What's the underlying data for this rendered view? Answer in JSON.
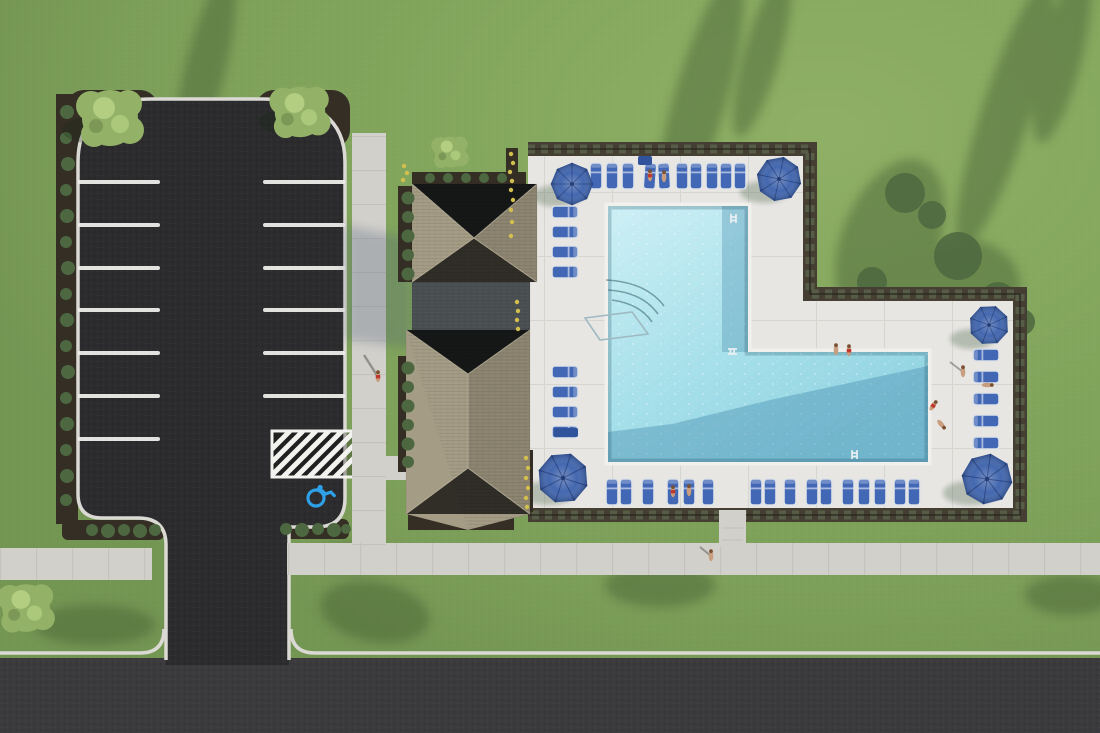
{
  "scene": {
    "type": "aerial-architectural-rendering",
    "subject": "Top-down 3D rendering of a community amenity: parking lot, clubhouse with shingled hip roofs, and a fenced L-shaped swimming pool with sun deck",
    "setting": "green lawn with long tree shadows, access road along the bottom edge"
  },
  "colors": {
    "grass": "#7ea25a",
    "grass_shadow": "#3f5c33",
    "asphalt": "#2c2b2d",
    "road": "#3b3a3d",
    "curb": "#dbd9d4",
    "sidewalk": "#d2d0cb",
    "deck": "#e7e6e2",
    "mulch": "#342e25",
    "hedge": "#453f33",
    "hedge_leaf": "#59624a",
    "water_light": "#c9edf3",
    "water_mid": "#9fdce8",
    "water_deep": "#4e93b4",
    "pool_coping": "#f1f0ec",
    "umbrella": "#3a60ab",
    "lounger": "#4167b5",
    "lounger_frame": "#dde2e8",
    "roof_light": "#a59c85",
    "roof_mid": "#8d8571",
    "roof_dark": "#4c5154",
    "tree": "#93b267",
    "bush": "#4d6840",
    "flower_yellow": "#d3bf4e",
    "stripe": "#f2f2ef",
    "accessible_blue": "#2da0e8",
    "skin": "#c89e7e",
    "table_blue": "#31539b"
  },
  "inventory": {
    "umbrellas": 5,
    "loungers": 39,
    "side_tables": 2,
    "people": 12,
    "trees": 4,
    "pool_ladders": 3,
    "pool_handrails": 1,
    "parking_stripes_left": 7,
    "parking_stripes_right": 6,
    "accessible_spaces": 1,
    "pool_shape": "L-shaped"
  }
}
